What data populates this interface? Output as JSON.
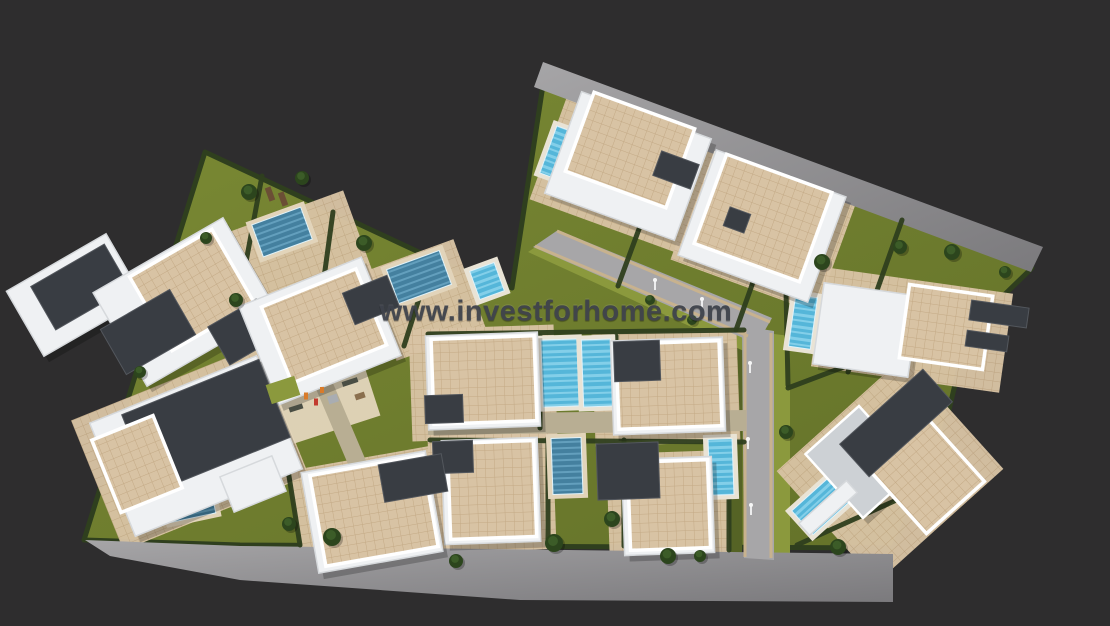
{
  "watermark": {
    "text": "www.investforhome.com",
    "color": "#3f434c"
  },
  "palette": {
    "bg": "#2e2d2e",
    "grass1": "#7b8a34",
    "grass2": "#637129",
    "grassLight": "#8b993d",
    "grassDark": "#556325",
    "hedge": "#2f3f1e",
    "paveLine": "#c3a985",
    "paveBg": "#d8c3a4",
    "paveLight": "#e2d4ba",
    "road1": "#a6a5a7",
    "road2": "#7b7a7d",
    "roadInner": "#a7a6a8",
    "curb": "#c8b28e",
    "walk": "#b8ae93",
    "water": "#55b6d9",
    "waterStripe": "#83cfe9",
    "waterDark": "#44809f",
    "waterDarkStripe": "#639fbd",
    "deck": "#e9e3d5",
    "white": "#eff1f3",
    "whiteEdge": "#ffffff",
    "dark": "#393d43",
    "darkEdge": "#53575d",
    "gray": "#cdd1d5",
    "palm": "#2c451d",
    "palmLight": "#3c5c28",
    "wood": "#6b4e35",
    "shadow": "rgba(0,0,0,0.22)",
    "light": "#ededee"
  },
  "scene": {
    "site": {
      "points": "205,152 440,262 512,288 543,85 1032,268 968,330 938,456 893,548 240,545 84,540"
    },
    "roads": [
      {
        "name": "top-road",
        "points": "543,62 1043,247 1031,272 534,87",
        "kind": "outer"
      },
      {
        "name": "bottom-road",
        "points": "85,540 240,546 893,554 893,602 520,600 240,580 110,556",
        "kind": "outer"
      },
      {
        "name": "entry-road",
        "points": "533,247 558,230 772,318 757,344",
        "kind": "inner"
      },
      {
        "name": "main-road",
        "points": "742,326 774,331 774,560 744,558",
        "kind": "inner"
      }
    ],
    "verges": [
      {
        "name": "verge-main-left",
        "points": "728,324 742,326 742,556 728,554",
        "tone": "dark"
      },
      {
        "name": "verge-main-right",
        "points": "774,334 790,336 790,556 774,558",
        "tone": "light"
      },
      {
        "name": "verge-entry-lower",
        "points": "528,252 540,244 756,342 746,352",
        "tone": "light"
      }
    ],
    "curbs": [
      {
        "x1": 745,
        "y1": 330,
        "x2": 745,
        "y2": 557
      },
      {
        "x1": 771,
        "y1": 333,
        "x2": 771,
        "y2": 558
      },
      {
        "x1": 535,
        "y1": 246,
        "x2": 748,
        "y2": 336
      },
      {
        "x1": 557,
        "y1": 231,
        "x2": 770,
        "y2": 322
      }
    ],
    "walkways": [
      {
        "name": "walkway-horizontal",
        "points": "428,414 746,410 746,431 428,435"
      },
      {
        "name": "walkway-left-diagonal",
        "points": "296,342 312,334 404,550 388,558"
      }
    ],
    "paving": [
      {
        "cx": 300,
        "cy": 262,
        "w": 130,
        "h": 105,
        "a": -20
      },
      {
        "cx": 425,
        "cy": 300,
        "w": 95,
        "h": 95,
        "a": -20
      },
      {
        "cx": 630,
        "cy": 172,
        "w": 170,
        "h": 120,
        "a": 20
      },
      {
        "cx": 763,
        "cy": 232,
        "w": 155,
        "h": 115,
        "a": 20
      },
      {
        "cx": 912,
        "cy": 330,
        "w": 190,
        "h": 100,
        "a": 8
      },
      {
        "cx": 890,
        "cy": 470,
        "w": 170,
        "h": 150,
        "a": -42
      },
      {
        "cx": 190,
        "cy": 448,
        "w": 200,
        "h": 140,
        "a": -22
      },
      {
        "cx": 372,
        "cy": 512,
        "w": 150,
        "h": 110,
        "a": -10
      },
      {
        "cx": 483,
        "cy": 383,
        "w": 145,
        "h": 112,
        "a": -2
      },
      {
        "cx": 666,
        "cy": 388,
        "w": 145,
        "h": 112,
        "a": -2
      },
      {
        "cx": 492,
        "cy": 492,
        "w": 125,
        "h": 118,
        "a": -2
      },
      {
        "cx": 668,
        "cy": 506,
        "w": 120,
        "h": 108,
        "a": -2
      },
      {
        "cx": 311,
        "cy": 396,
        "w": 120,
        "h": 80,
        "a": -18,
        "light": true
      }
    ],
    "hedges": [
      {
        "x1": 333,
        "y1": 212,
        "x2": 316,
        "y2": 336
      },
      {
        "x1": 430,
        "y1": 264,
        "x2": 404,
        "y2": 346
      },
      {
        "x1": 262,
        "y1": 176,
        "x2": 246,
        "y2": 262
      },
      {
        "x1": 674,
        "y1": 134,
        "x2": 618,
        "y2": 286
      },
      {
        "x1": 790,
        "y1": 178,
        "x2": 736,
        "y2": 330
      },
      {
        "x1": 902,
        "y1": 220,
        "x2": 848,
        "y2": 372
      },
      {
        "x1": 540,
        "y1": 336,
        "x2": 540,
        "y2": 428
      },
      {
        "x1": 616,
        "y1": 336,
        "x2": 616,
        "y2": 428
      },
      {
        "x1": 548,
        "y1": 438,
        "x2": 548,
        "y2": 542
      },
      {
        "x1": 624,
        "y1": 440,
        "x2": 624,
        "y2": 546
      },
      {
        "x1": 729,
        "y1": 440,
        "x2": 729,
        "y2": 550
      },
      {
        "x1": 428,
        "y1": 334,
        "x2": 744,
        "y2": 330
      },
      {
        "x1": 430,
        "y1": 440,
        "x2": 744,
        "y2": 442
      },
      {
        "x1": 786,
        "y1": 290,
        "x2": 788,
        "y2": 385
      },
      {
        "x1": 788,
        "y1": 388,
        "x2": 955,
        "y2": 325
      },
      {
        "x1": 797,
        "y1": 545,
        "x2": 963,
        "y2": 470
      },
      {
        "x1": 280,
        "y1": 420,
        "x2": 300,
        "y2": 545
      }
    ],
    "pools": [
      {
        "name": "pool-left-1",
        "cx": 282,
        "cy": 232,
        "w": 52,
        "h": 34,
        "a": -20,
        "tone": "dark"
      },
      {
        "name": "pool-left-2",
        "cx": 419,
        "cy": 277,
        "w": 56,
        "h": 36,
        "a": -20,
        "tone": "dark"
      },
      {
        "name": "pool-left-3",
        "cx": 487,
        "cy": 281,
        "w": 26,
        "h": 30,
        "a": -20,
        "tone": "light"
      },
      {
        "name": "pool-left-4",
        "cx": 190,
        "cy": 502,
        "w": 46,
        "h": 32,
        "a": -12,
        "tone": "dark"
      },
      {
        "name": "pool-top-1",
        "cx": 561,
        "cy": 154,
        "w": 27,
        "h": 50,
        "a": 20,
        "tone": "light"
      },
      {
        "name": "pool-top-2",
        "cx": 727,
        "cy": 172,
        "w": 28,
        "h": 22,
        "a": 20,
        "tone": "light"
      },
      {
        "name": "pool-right-1",
        "cx": 803,
        "cy": 322,
        "w": 22,
        "h": 52,
        "a": 8,
        "tone": "light"
      },
      {
        "name": "pool-center-1",
        "cx": 560,
        "cy": 373,
        "w": 36,
        "h": 67,
        "a": -2,
        "tone": "light"
      },
      {
        "name": "pool-center-2",
        "cx": 597,
        "cy": 373,
        "w": 29,
        "h": 67,
        "a": -2,
        "tone": "light"
      },
      {
        "name": "pool-center-3",
        "cx": 567,
        "cy": 466,
        "w": 30,
        "h": 56,
        "a": -2,
        "tone": "dark"
      },
      {
        "name": "pool-center-4",
        "cx": 721,
        "cy": 467,
        "w": 24,
        "h": 56,
        "a": -2,
        "tone": "light"
      },
      {
        "name": "pool-right-2",
        "cx": 821,
        "cy": 506,
        "w": 50,
        "h": 32,
        "a": -42,
        "tone": "light"
      }
    ],
    "buildings": [
      {
        "name": "villa-far-left",
        "parts": [
          {
            "t": "white",
            "cx": 75,
            "cy": 295,
            "w": 115,
            "h": 75,
            "a": -30
          },
          {
            "t": "dark",
            "cx": 80,
            "cy": 287,
            "w": 85,
            "h": 50,
            "a": -30
          }
        ]
      },
      {
        "name": "villa-left-1",
        "parts": [
          {
            "t": "white",
            "cx": 185,
            "cy": 302,
            "w": 150,
            "h": 108,
            "a": -30
          },
          {
            "t": "tile",
            "cx": 192,
            "cy": 290,
            "w": 95,
            "h": 85,
            "a": -30
          },
          {
            "t": "dark",
            "cx": 148,
            "cy": 332,
            "w": 80,
            "h": 52,
            "a": -30
          },
          {
            "t": "dark",
            "cx": 243,
            "cy": 332,
            "w": 56,
            "h": 44,
            "a": -30
          }
        ]
      },
      {
        "name": "villa-left-2",
        "parts": [
          {
            "t": "white",
            "cx": 320,
            "cy": 331,
            "w": 132,
            "h": 106,
            "a": -22
          },
          {
            "t": "tile",
            "cx": 324,
            "cy": 326,
            "w": 102,
            "h": 82,
            "a": -22
          },
          {
            "t": "dark",
            "cx": 371,
            "cy": 300,
            "w": 48,
            "h": 34,
            "a": -22
          }
        ]
      },
      {
        "name": "villa-left-3",
        "parts": [
          {
            "t": "white",
            "cx": 196,
            "cy": 446,
            "w": 180,
            "h": 122,
            "a": -22
          },
          {
            "t": "dark",
            "cx": 206,
            "cy": 426,
            "w": 148,
            "h": 84,
            "a": -22
          },
          {
            "t": "tile",
            "cx": 137,
            "cy": 464,
            "w": 66,
            "h": 78,
            "a": -22
          },
          {
            "t": "white",
            "cx": 253,
            "cy": 484,
            "w": 56,
            "h": 38,
            "a": -22
          }
        ]
      },
      {
        "name": "villa-top-1",
        "parts": [
          {
            "t": "white",
            "cx": 628,
            "cy": 166,
            "w": 138,
            "h": 108,
            "a": 20
          },
          {
            "t": "tile",
            "cx": 630,
            "cy": 150,
            "w": 107,
            "h": 84,
            "a": 20
          },
          {
            "t": "dark",
            "cx": 676,
            "cy": 170,
            "w": 40,
            "h": 26,
            "a": 20
          }
        ]
      },
      {
        "name": "villa-top-2",
        "parts": [
          {
            "t": "white",
            "cx": 762,
            "cy": 226,
            "w": 138,
            "h": 112,
            "a": 20
          },
          {
            "t": "tile",
            "cx": 763,
            "cy": 218,
            "w": 112,
            "h": 95,
            "a": 20
          },
          {
            "t": "dark",
            "cx": 737,
            "cy": 220,
            "w": 22,
            "h": 20,
            "a": 20
          }
        ]
      },
      {
        "name": "villa-right-1",
        "parts": [
          {
            "t": "white",
            "cx": 866,
            "cy": 330,
            "w": 96,
            "h": 82,
            "a": 8
          },
          {
            "t": "tile",
            "cx": 946,
            "cy": 327,
            "w": 84,
            "h": 74,
            "a": 8
          },
          {
            "t": "dark",
            "cx": 999,
            "cy": 314,
            "w": 58,
            "h": 20,
            "a": 8
          },
          {
            "t": "dark",
            "cx": 987,
            "cy": 341,
            "w": 42,
            "h": 16,
            "a": 8
          }
        ]
      },
      {
        "name": "villa-right-2",
        "parts": [
          {
            "t": "gray",
            "cx": 861,
            "cy": 462,
            "w": 72,
            "h": 86,
            "a": -42
          },
          {
            "t": "tile",
            "cx": 928,
            "cy": 477,
            "w": 78,
            "h": 82,
            "a": -42
          },
          {
            "t": "dark",
            "cx": 896,
            "cy": 423,
            "w": 112,
            "h": 44,
            "a": -42
          },
          {
            "t": "white",
            "cx": 828,
            "cy": 508,
            "w": 64,
            "h": 16,
            "a": -42
          }
        ]
      },
      {
        "name": "villa-center-1",
        "parts": [
          {
            "t": "white",
            "cx": 483,
            "cy": 381,
            "w": 112,
            "h": 94,
            "a": -2
          },
          {
            "t": "tile",
            "cx": 484,
            "cy": 380,
            "w": 103,
            "h": 85,
            "a": -2
          },
          {
            "t": "dark",
            "cx": 444,
            "cy": 409,
            "w": 38,
            "h": 28,
            "a": -2
          }
        ]
      },
      {
        "name": "villa-center-2",
        "parts": [
          {
            "t": "white",
            "cx": 668,
            "cy": 386,
            "w": 112,
            "h": 94,
            "a": -2
          },
          {
            "t": "tile",
            "cx": 669,
            "cy": 385,
            "w": 103,
            "h": 85,
            "a": -2
          },
          {
            "t": "dark",
            "cx": 637,
            "cy": 361,
            "w": 46,
            "h": 40,
            "a": -2
          }
        ]
      },
      {
        "name": "villa-center-3",
        "parts": [
          {
            "t": "white",
            "cx": 491,
            "cy": 491,
            "w": 96,
            "h": 104,
            "a": -2
          },
          {
            "t": "tile",
            "cx": 492,
            "cy": 490,
            "w": 86,
            "h": 96,
            "a": -2
          },
          {
            "t": "dark",
            "cx": 453,
            "cy": 457,
            "w": 40,
            "h": 32,
            "a": -2
          }
        ]
      },
      {
        "name": "villa-center-4",
        "parts": [
          {
            "t": "white",
            "cx": 668,
            "cy": 506,
            "w": 90,
            "h": 96,
            "a": -2
          },
          {
            "t": "tile",
            "cx": 669,
            "cy": 505,
            "w": 80,
            "h": 88,
            "a": -2
          },
          {
            "t": "dark",
            "cx": 628,
            "cy": 471,
            "w": 62,
            "h": 56,
            "a": -2
          }
        ]
      },
      {
        "name": "villa-bottom-left",
        "parts": [
          {
            "t": "white",
            "cx": 372,
            "cy": 512,
            "w": 126,
            "h": 102,
            "a": -10
          },
          {
            "t": "tile",
            "cx": 374,
            "cy": 511,
            "w": 114,
            "h": 92,
            "a": -10
          },
          {
            "t": "dark",
            "cx": 413,
            "cy": 478,
            "w": 64,
            "h": 38,
            "a": -10
          }
        ]
      }
    ],
    "playground": [
      {
        "name": "bench",
        "cx": 350,
        "cy": 382,
        "w": 16,
        "h": 5,
        "a": -18,
        "fill": "#4a4e44"
      },
      {
        "name": "bench",
        "cx": 296,
        "cy": 408,
        "w": 14,
        "h": 5,
        "a": -18,
        "fill": "#4a4e44"
      },
      {
        "name": "slide",
        "cx": 333,
        "cy": 399,
        "w": 10,
        "h": 8,
        "a": -18,
        "fill": "#a9adb2"
      },
      {
        "name": "grass-patch",
        "cx": 283,
        "cy": 390,
        "w": 30,
        "h": 20,
        "a": -18,
        "fill": "#8b993d"
      },
      {
        "name": "picnic-table",
        "cx": 360,
        "cy": 396,
        "w": 10,
        "h": 6,
        "a": -18,
        "fill": "#8a6f4e"
      },
      {
        "name": "figure",
        "cx": 306,
        "cy": 396,
        "w": 4,
        "h": 7,
        "a": 0,
        "fill": "#d97b2a"
      },
      {
        "name": "figure",
        "cx": 316,
        "cy": 402,
        "w": 4,
        "h": 7,
        "a": 0,
        "fill": "#c23b2e"
      },
      {
        "name": "figure",
        "cx": 322,
        "cy": 390,
        "w": 4,
        "h": 6,
        "a": 0,
        "fill": "#d97b2a"
      }
    ],
    "pergola": [
      {
        "cx": 270,
        "cy": 194,
        "w": 6,
        "h": 14,
        "a": -20
      },
      {
        "cx": 283,
        "cy": 199,
        "w": 6,
        "h": 14,
        "a": -20
      }
    ],
    "trees": [
      {
        "x": 249,
        "y": 192,
        "r": 8
      },
      {
        "x": 302,
        "y": 178,
        "r": 7
      },
      {
        "x": 364,
        "y": 243,
        "r": 8
      },
      {
        "x": 236,
        "y": 300,
        "r": 7
      },
      {
        "x": 554,
        "y": 543,
        "r": 9
      },
      {
        "x": 612,
        "y": 519,
        "r": 8
      },
      {
        "x": 668,
        "y": 556,
        "r": 8
      },
      {
        "x": 822,
        "y": 262,
        "r": 8
      },
      {
        "x": 900,
        "y": 247,
        "r": 7
      },
      {
        "x": 952,
        "y": 252,
        "r": 8
      },
      {
        "x": 1005,
        "y": 272,
        "r": 6
      },
      {
        "x": 786,
        "y": 432,
        "r": 7
      },
      {
        "x": 838,
        "y": 547,
        "r": 8
      },
      {
        "x": 332,
        "y": 537,
        "r": 9
      },
      {
        "x": 289,
        "y": 524,
        "r": 7
      },
      {
        "x": 456,
        "y": 561,
        "r": 7
      },
      {
        "x": 700,
        "y": 556,
        "r": 6
      },
      {
        "x": 140,
        "y": 372,
        "r": 6
      },
      {
        "x": 206,
        "y": 238,
        "r": 6
      },
      {
        "x": 650,
        "y": 300,
        "r": 5
      },
      {
        "x": 692,
        "y": 320,
        "r": 5
      }
    ],
    "lights": [
      {
        "x": 655,
        "y": 289
      },
      {
        "x": 702,
        "y": 308
      },
      {
        "x": 750,
        "y": 372
      },
      {
        "x": 748,
        "y": 448
      },
      {
        "x": 751,
        "y": 514
      }
    ]
  }
}
